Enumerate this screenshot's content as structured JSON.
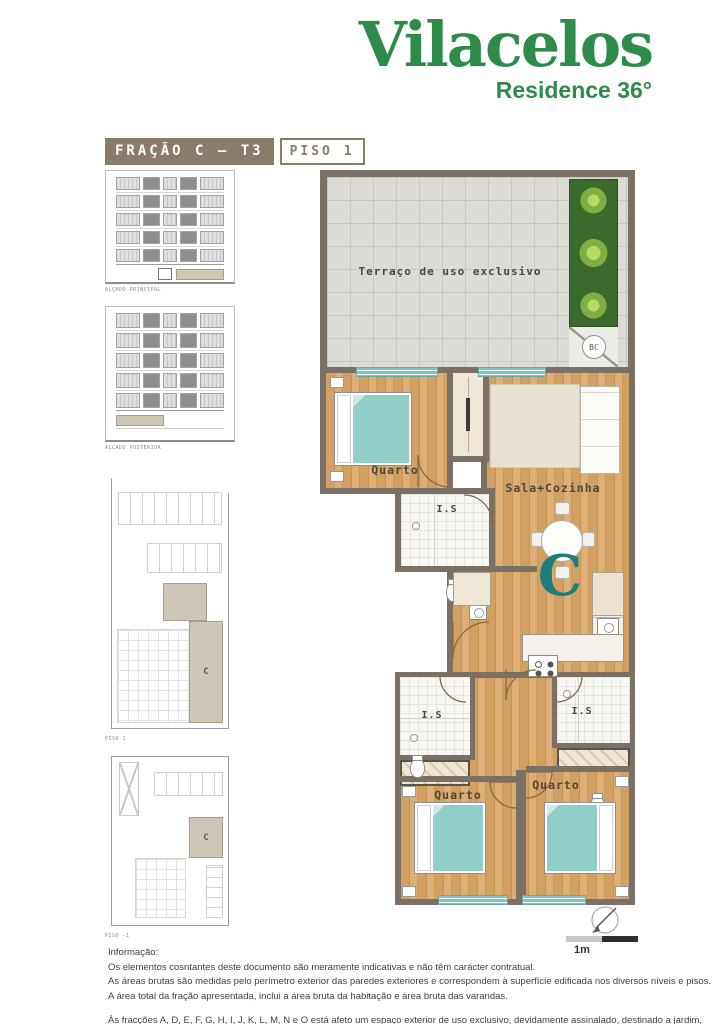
{
  "brand": {
    "name": "Vilacelos",
    "tagline": "Residence 36°",
    "color": "#2e8b49"
  },
  "header": {
    "fraction_label": "FRAÇÃO C – T3",
    "floor_label": "PISO 1"
  },
  "sidebar": {
    "figures": [
      {
        "label": "ALÇADO PRINCIPAL"
      },
      {
        "label": "ALÇADO POSTERIOR"
      },
      {
        "label": "PISO 1",
        "unit": "C"
      },
      {
        "label": "PISO -1",
        "unit": "C"
      }
    ]
  },
  "floor_plan": {
    "terrace_label": "Terraço de uso exclusivo",
    "bc_label": "BC",
    "unit_letter": "C",
    "rooms": {
      "quarto1": "Quarto",
      "sala": "Sala+Cozinha",
      "is1": "I.S",
      "is2": "I.S",
      "is3": "I.S",
      "quarto2": "Quarto",
      "quarto3": "Quarto"
    },
    "colors": {
      "wall": "#7a7065",
      "wood_floor": "#d9a96c",
      "window_teal": "#7ec7c4",
      "unit_letter_teal": "#1e7e7c",
      "header_taupe": "#8a7c68",
      "brand_green": "#2e8b49"
    }
  },
  "scale": {
    "label": "1m"
  },
  "footer": {
    "info_title": "Informação:",
    "lines": [
      "Os elementos cosntantes deste documento são meramente indicativas e não têm carácter contratual.",
      "As áreas brutas são medidas pelo perímetro exterior das paredes exteriores e correspondem à superfície edificada nos diversos níveis e pisos.",
      "A área total da fração apresentada, inclui a área bruta da habitação e área bruta das varandas."
    ],
    "note": "Às fracções A, D, E, F, G, H, I, J, K, L, M, N e O está afeto um espaço exterior de uso exclusivo, devidamente assinalado, destinado a jardim, dependente de aprovação camarária."
  }
}
